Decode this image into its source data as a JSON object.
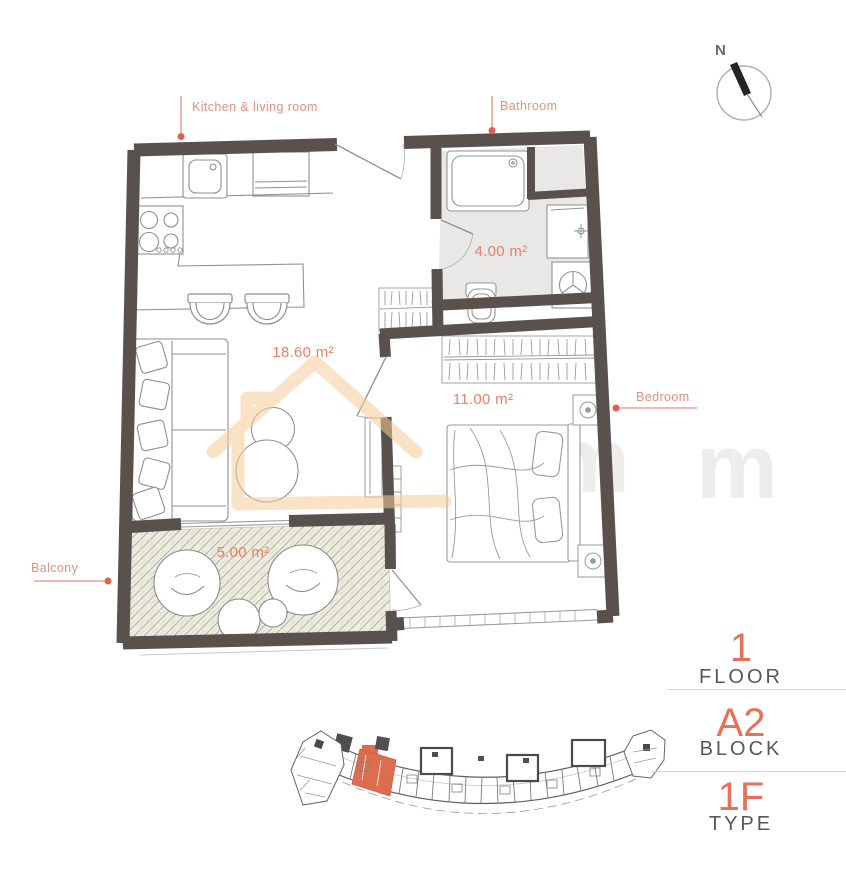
{
  "floor_plan": {
    "room_labels": {
      "kitchen_living": "Kitchen & living room",
      "bathroom": "Bathroom",
      "bedroom": "Bedroom",
      "balcony": "Balcony"
    },
    "room_areas": {
      "kitchen_living": "18.60 m²",
      "bathroom": "4.00 m²",
      "bedroom": "11.00 m²",
      "balcony": "5.00 m²"
    },
    "compass": {
      "north": "N"
    }
  },
  "watermark": {
    "letters": [
      "m",
      "m"
    ]
  },
  "info_panel": {
    "floor": {
      "value": "1",
      "label": "FLOOR"
    },
    "block": {
      "value": "A2",
      "label": "BLOCK"
    },
    "unit_type": {
      "value": "1F",
      "label": "TYPE"
    }
  },
  "colors": {
    "accent": "#e4725a",
    "label_salmon": "#df9180",
    "leader_dot": "#e2604a",
    "wall": "#59514d",
    "bathroom_floor": "#e9e8e6",
    "balcony_floor": "#edecdf",
    "balcony_hatch": "#b7baa9",
    "watermark_orange": "#f6cc9b",
    "sketch_line": "#8f8f8f",
    "divider": "#d8d8d8",
    "site_unit_highlight": "#dc6e4e"
  }
}
